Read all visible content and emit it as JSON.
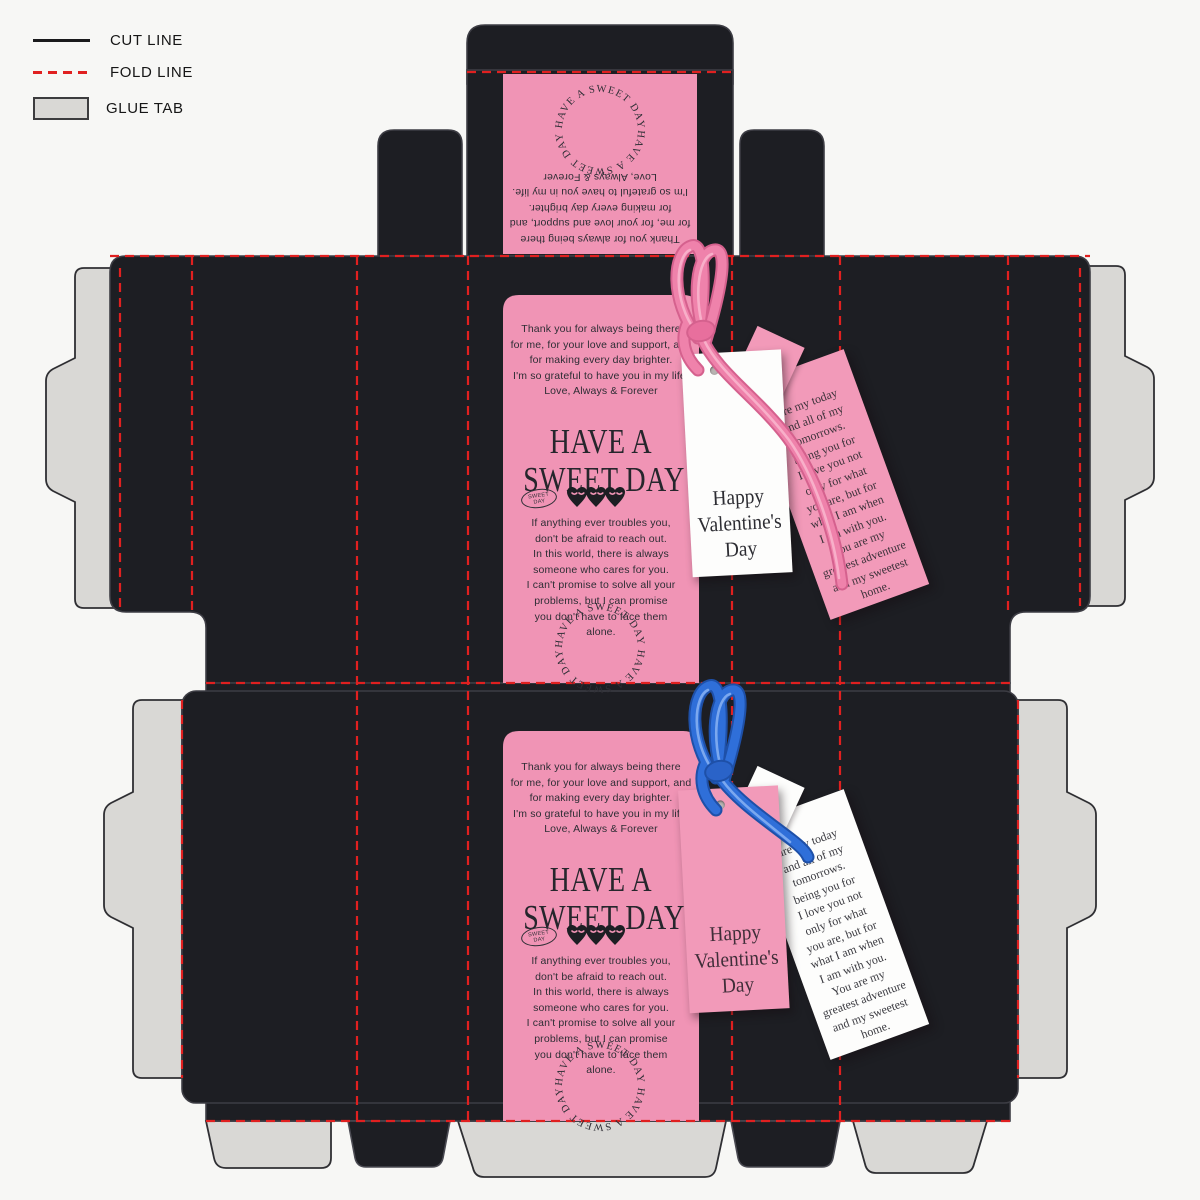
{
  "legend": {
    "items": [
      {
        "label": "CUT LINE",
        "swatch": "solid-black-line"
      },
      {
        "label": "FOLD LINE",
        "swatch": "red-dashed-line"
      },
      {
        "label": "GLUE TAB",
        "swatch": "gray-rectangle"
      }
    ]
  },
  "print": {
    "thanks_message": "Thank you for always being there\nfor me, for your love and support, and\nfor making every day brighter.\nI'm so grateful to have you in my life.\nLove, Always & Forever",
    "title_line1": "HAVE A",
    "title_line2": "SWEET DAY",
    "badge_text": "SWEET\nDAY",
    "hearts_icon": "three-hearts-closed-eyes",
    "comfort_message": "If anything ever troubles you,\ndon't be afraid to reach out.\nIn this world, there is always\nsomeone who cares for you.\nI can't promise to solve all your\nproblems, but I can promise\nyou don't have to face them\nalone.",
    "circle_text": "HAVE A SWEET DAY HAVE A SWEET DAY "
  },
  "tags": {
    "front_label": "Happy\nValentine's\nDay",
    "back_quote": "are my today\nand all of my\ntomorrows.\nbeing you for\nI love you not\nonly for what\nyou are, but for\nwhat I am when\nI am with you.\nYou are my\ngreatest adventure\nand my sweetest\nhome."
  },
  "colors": {
    "background": "#f7f7f5",
    "panel_black": "#1d1e23",
    "print_pink": "#f094b5",
    "tag_pink": "#f29ab9",
    "tag_white": "#fdfdfc",
    "glue_gray": "#d9d8d5",
    "fold_red": "#e02020",
    "ribbon_pink": "#ef82ab",
    "ribbon_blue": "#2f6fd9",
    "ink": "#2e2e35"
  }
}
